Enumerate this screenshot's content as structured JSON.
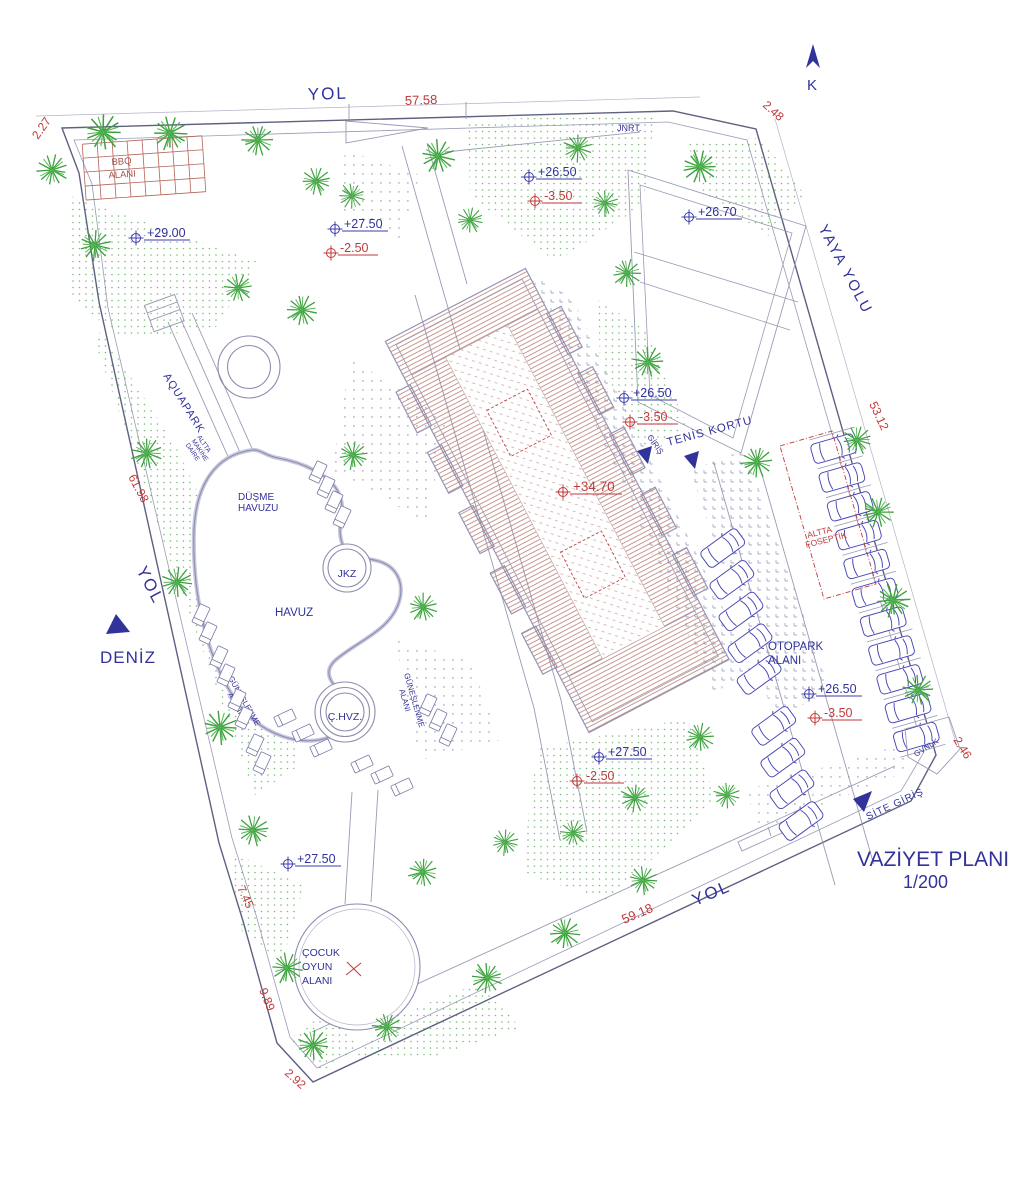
{
  "drawing": {
    "title": "VAZİYET PLANI",
    "scale": "1/200",
    "compass": "K",
    "roads": {
      "top": "YOL",
      "left": "YOL",
      "bottom": "YOL",
      "pedestrian": "YAYA YOLU",
      "sea": "DENİZ"
    },
    "dimensions": {
      "top_corner": "2.27",
      "top": "57.58",
      "top_right_corner": "2.48",
      "right": "53.12",
      "left": "61.98",
      "left_lower": "7.45",
      "left_bottom": "9.89",
      "bottom_corner": "2.92",
      "bottom": "59.18",
      "bottom_right_corner": "2.46"
    },
    "areas": {
      "bbq": [
        "BBQ",
        "ALANI"
      ],
      "generator": "JNRT.",
      "aquapark": "AQUAPARK",
      "machine_room": [
        "ALTTA",
        "MAKİNE",
        "DAİRE"
      ],
      "drop_pool": [
        "DÜŞME",
        "HAVUZU"
      ],
      "jacuzzi": "JKZ",
      "pool": "HAVUZ",
      "kids_pool": "Ç.HVZ.",
      "sunbathing": [
        "GÜNEŞLENME",
        "ALANI"
      ],
      "tennis": "TENİS KORTU",
      "entrance": "GİRİŞ",
      "parking": [
        "OTOPARK",
        "ALANI"
      ],
      "septic": [
        "ALTTA",
        "FOSEPTİK"
      ],
      "guard": "GVNLK",
      "site_entrance": "SİTE GİRİŞ",
      "playground": [
        "ÇOCUK",
        "OYUN",
        "ALANI"
      ]
    },
    "elevations": {
      "nw": "+29.00",
      "n1_up": "+27.50",
      "n1_dn": "-2.50",
      "n2_up": "+26.50",
      "n2_dn": "-3.50",
      "tennis_lot": "+26.70",
      "e1_up": "+26.50",
      "e1_dn": "-3.50",
      "roof": "+34.70",
      "park_up": "+26.50",
      "park_dn": "-3.50",
      "s1_up": "+27.50",
      "s1_dn": "-2.50",
      "sw": "+27.50"
    },
    "colors": {
      "ink": "#32329b",
      "dimension": "#c13a3a",
      "tree": "#3da23d",
      "roof_hatch": "#b4786e",
      "car": "#4646b4"
    }
  }
}
